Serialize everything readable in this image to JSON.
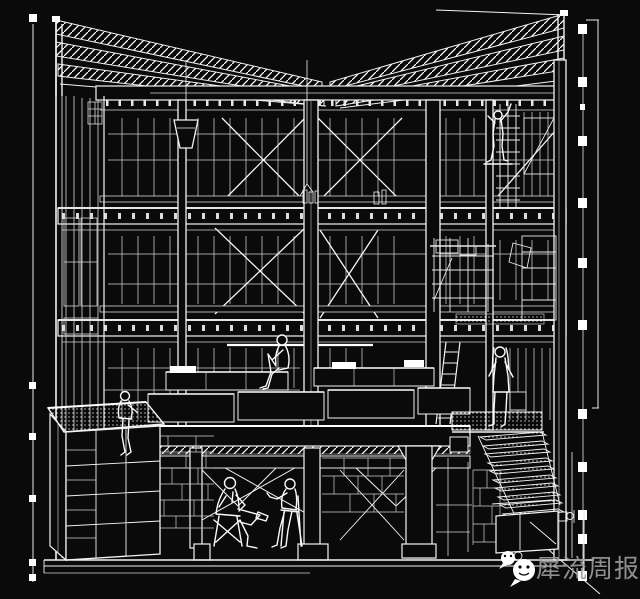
{
  "meta": {
    "background_color": "#0a0a0b",
    "line_color": "#f2f2f2",
    "watermark_text_color": "#9b9b9b",
    "canvas": {
      "width": 640,
      "height": 599
    }
  },
  "drawing": {
    "title": "Cutaway section perspective of a three-storey timber-frame building",
    "style": "white wireframe line art on black background",
    "stories": 3,
    "elements": [
      "slatted roof planes with hatched rafters sloping to the centre",
      "glazed mullion walls on every storey",
      "X cross-bracing on upper and middle storeys",
      "pendant lamp hanging from roof beam",
      "central platform with benches and white cushions",
      "scaffold shelving tower and leaning ladder",
      "dotted-tread staircase descending to the lower right",
      "kiosk with gravel roof at lower left",
      "stone block masonry walls",
      "basement lounge with two seated figures on chairs",
      "survey scale bar and registration tick marks at the edges"
    ],
    "figures": [
      {
        "id": "seated-on-platform",
        "pose": "sitting with knees drawn up, facing left",
        "location": "centre platform"
      },
      {
        "id": "kiosk-roof-sitter",
        "pose": "sitting on kiosk roof edge, legs dangling",
        "location": "lower left"
      },
      {
        "id": "climber",
        "pose": "climbing scaffold with arm raised",
        "location": "upper right"
      },
      {
        "id": "standing-woman",
        "pose": "standing, long hair, facing the building",
        "location": "right, on stair landing"
      },
      {
        "id": "seated-man-crossed-legs",
        "pose": "leaning back on folding chair, legs crossed",
        "location": "basement left"
      },
      {
        "id": "seated-companion",
        "pose": "sitting opposite, arm raised",
        "location": "basement centre"
      }
    ]
  },
  "annotations": {
    "left_tick_ys": [
      18,
      386,
      437,
      499,
      563,
      578
    ],
    "right_scale_tick_ys": [
      28,
      81,
      140,
      203,
      262,
      324,
      413,
      466,
      514,
      538,
      575
    ],
    "right_reference_line": {
      "x": 598,
      "y1": 20,
      "y2": 408
    }
  },
  "watermark": {
    "text": "犀流周报",
    "icon": "wechat-chat-bubbles-icon"
  }
}
